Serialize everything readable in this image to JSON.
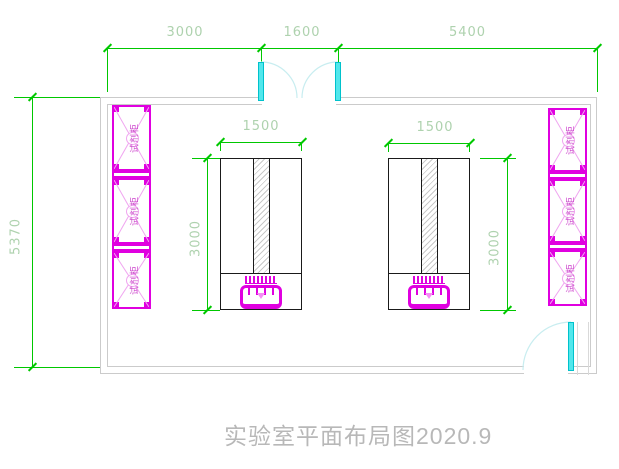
{
  "title": {
    "text": "实验室平面布局图2020.9"
  },
  "dimensions": {
    "top_left": "3000",
    "top_middle": "1600",
    "top_right": "5400",
    "room_height": "5370",
    "bench_width": "1500",
    "bench_height": "3000"
  },
  "cabinets": {
    "label": "试剂柜"
  },
  "colors": {
    "dimension_line": "#00c800",
    "dimension_text": "#aed2ae",
    "wall": "#cbcbcb",
    "cabinet": "#e000e0",
    "cabinet_hatch": "#f0a6f0",
    "door_leaf": "#52e7ec",
    "door_arc": "#c8edf0",
    "bench_outline": "#1a1a1a",
    "title_text": "#b8b8b8"
  }
}
